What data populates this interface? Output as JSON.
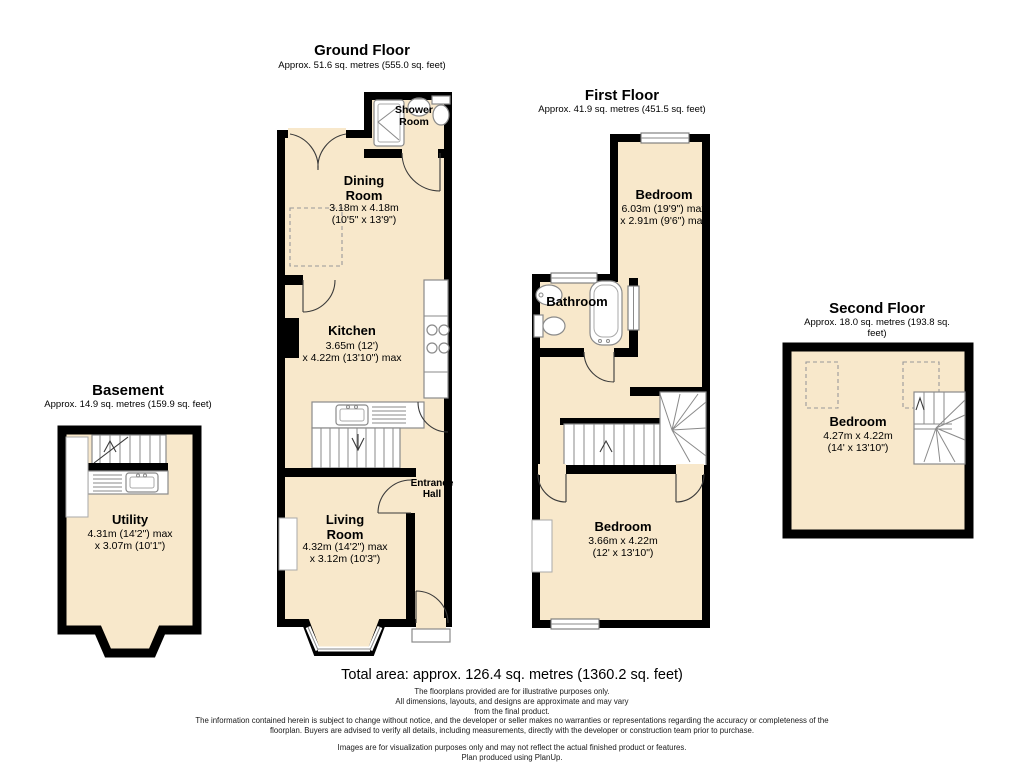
{
  "colors": {
    "room_fill": "#F8E8CB",
    "wall": "#000000",
    "fixture_stroke": "#8A8A8A",
    "background": "#FFFFFF"
  },
  "floors": {
    "basement": {
      "title": "Basement",
      "area": "Approx. 14.9 sq. metres (159.9 sq. feet)",
      "rooms": {
        "utility": {
          "name": "Utility",
          "dims": "4.31m (14'2\") max\nx 3.07m (10'1\")"
        }
      }
    },
    "ground": {
      "title": "Ground Floor",
      "area": "Approx. 51.6 sq. metres (555.0 sq. feet)",
      "rooms": {
        "shower": {
          "name": "Shower\nRoom"
        },
        "dining": {
          "name": "Dining\nRoom",
          "dims": "3.18m x 4.18m\n(10'5\" x 13'9\")"
        },
        "kitchen": {
          "name": "Kitchen",
          "dims": "3.65m (12')\nx 4.22m (13'10\") max"
        },
        "entrance": {
          "name": "Entrance\nHall"
        },
        "living": {
          "name": "Living\nRoom",
          "dims": "4.32m (14'2\") max\nx 3.12m (10'3\")"
        }
      }
    },
    "first": {
      "title": "First Floor",
      "area": "Approx. 41.9 sq. metres (451.5 sq. feet)",
      "rooms": {
        "bedroom_top": {
          "name": "Bedroom",
          "dims": "6.03m (19'9\") max\nx 2.91m (9'6\") max"
        },
        "bathroom": {
          "name": "Bathroom"
        },
        "bedroom_bottom": {
          "name": "Bedroom",
          "dims": "3.66m x 4.22m\n(12' x 13'10\")"
        }
      }
    },
    "second": {
      "title": "Second Floor",
      "area": "Approx. 18.0 sq. metres (193.8 sq. feet)",
      "rooms": {
        "bedroom": {
          "name": "Bedroom",
          "dims": "4.27m x 4.22m\n(14' x 13'10\")"
        }
      }
    }
  },
  "footer": {
    "total_area": "Total area: approx. 126.4 sq. metres (1360.2 sq. feet)",
    "disclaimer_illustrative": "The floorplans provided are for illustrative purposes only.\nAll dimensions, layouts, and designs are approximate and may vary\nfrom the final product.",
    "disclaimer_information": "The information contained herein is subject to change without notice, and the developer or seller makes no warranties or representations regarding the accuracy or completeness of the\nfloorplan. Buyers are advised to verify all details, including measurements, directly with the developer or construction team prior to purchase.",
    "disclaimer_images": "Images are for visualization purposes only and may not reflect the actual finished product or features.\nPlan produced using PlanUp."
  }
}
